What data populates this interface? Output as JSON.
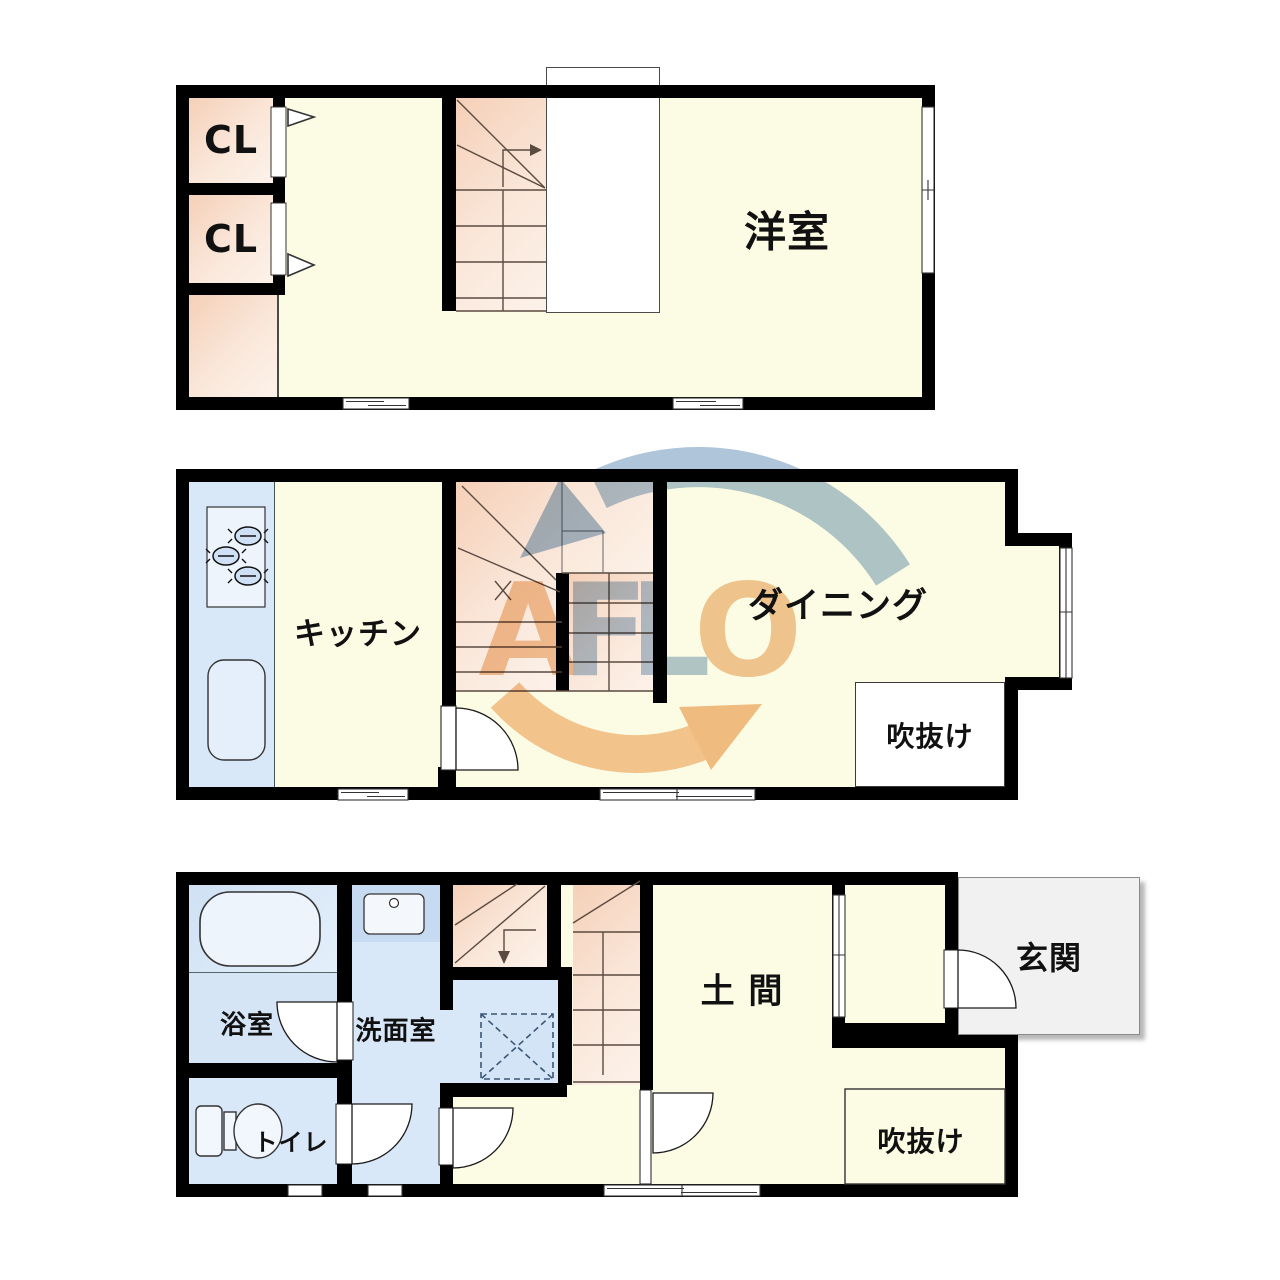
{
  "watermark": {
    "letters": [
      {
        "t": "A",
        "color": "#F2C69C"
      },
      {
        "t": "F",
        "color": "#B2C7DA"
      },
      {
        "t": "L",
        "color": "#B2C7DA"
      },
      {
        "t": "O",
        "color": "#F2C69C"
      }
    ],
    "arc_blue": "#AFC6DA",
    "arc_orange": "#F5C69A"
  },
  "colors": {
    "wall": "#000000",
    "floor": "#FCFCE5",
    "closet_and_stairs": "#F5D0B8",
    "water_rooms": "#D9E8F8",
    "entrance_porch": "#F1F1F1"
  },
  "floor_top": {
    "closet1_label": "CL",
    "closet2_label": "CL",
    "western_room_label": "洋室"
  },
  "floor_middle": {
    "kitchen_label": "キッチン",
    "dining_label": "ダイニング",
    "atrium_label": "吹抜け"
  },
  "floor_bottom": {
    "bathroom_label": "浴室",
    "washroom_label": "洗面室",
    "toilet_label": "トイレ",
    "doma_label": "土 間",
    "entrance_label": "玄関",
    "atrium_label": "吹抜け"
  }
}
